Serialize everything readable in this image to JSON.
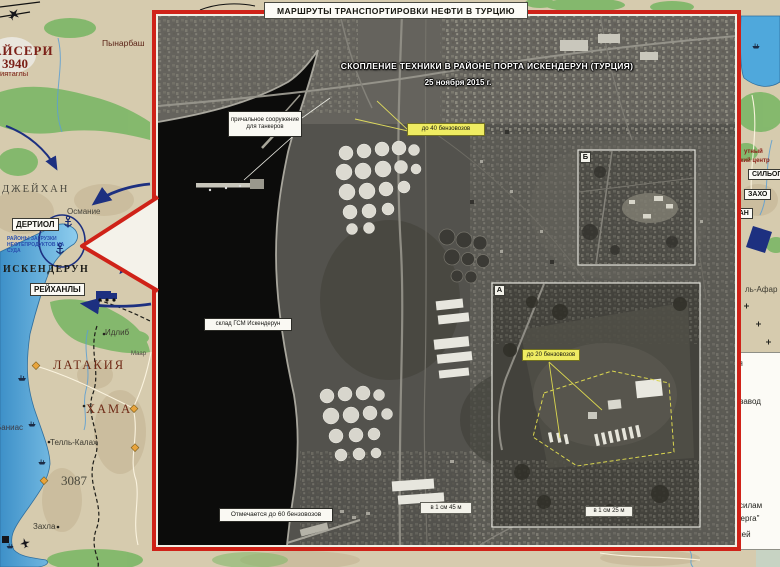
{
  "title": "МАРШРУТЫ ТРАНСПОРТИРОВКИ НЕФТИ В ТУРЦИЮ",
  "map": {
    "places": {
      "kayseri": "АЙСЕРИ",
      "kayseri_elevation": "3940",
      "kayseri_sub": "иятаглы",
      "pinarbasi": "Пынарбаш",
      "dzheikhan": "ДЖЕЙХАН",
      "osmaniye": "Османие",
      "islahie": "Исля",
      "dertiol": "ДЕРТИОЛ",
      "loading_note_line1": "РАЙОНЫ ЗАГРУЗКИ",
      "loading_note_line2": "НЕФТЕПРОДУКТОВ НА СУДА",
      "iskenderun": "ИСКЕНДЕРУН",
      "reyhanli": "РЕЙХАНЛЫ",
      "idlib": "Идлиб",
      "maar": "Маар",
      "latakia": "ЛАТАКИЯ",
      "hama": "ХАМА",
      "banias": "Баниас",
      "tell_kalah": "Телль-Калах",
      "elevation_3087": "3087",
      "zahla": "Захла",
      "hub_partial_1": "утный",
      "hub_partial_2": "ский центр",
      "silopi": "СИЛЬОПИ",
      "zakho": "ЗАХО",
      "van": "ВАН",
      "tal_afar": "ль-Афар"
    }
  },
  "satellite": {
    "caption_line1": "СКОПЛЕНИЕ ТЕХНИКИ В РАЙОНЕ ПОРТА ИСКЕНДЕРУН (ТУРЦИЯ)",
    "caption_line2": "25 ноября 2015 г.",
    "annotations": {
      "mooring_line1": "причальное сооружение",
      "mooring_line2": "для танкеров",
      "trucks_40": "до 40 бензовозов",
      "fuel_depot": "склад ГСМ Искендерун",
      "trucks_60": "Отмечается до 60 бензовозов",
      "scale_main": "в 1 см 45 м",
      "trucks_20": "до 20 бензовозов",
      "scale_inset": "в 1 см 25 м",
      "inset_a_letter": "А",
      "inset_b_letter": "Б"
    }
  },
  "legend_fragments": [
    "ия",
    "й завод",
    "силам",
    "мерга\"",
    "лей"
  ],
  "colors": {
    "frame_red": "#cf2218",
    "sea_blue": "#56aadb",
    "annotation_yellow": "#efec62",
    "route_navy": "#1d3080"
  }
}
